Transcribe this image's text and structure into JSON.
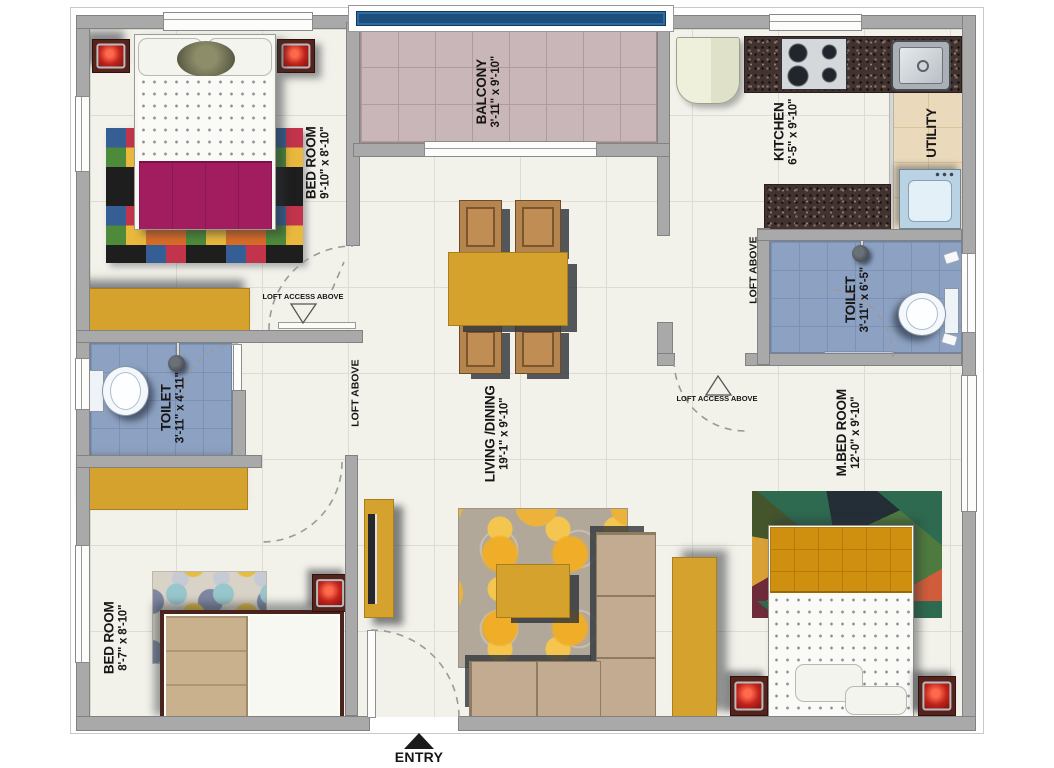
{
  "plan": {
    "rooms": {
      "bedroom_top_left": {
        "name": "BED ROOM",
        "dims": "9'-10\" x 8'-10\""
      },
      "balcony": {
        "name": "BALCONY",
        "dims": "3'-11\" x 9'-10\""
      },
      "kitchen": {
        "name": "KITCHEN",
        "dims": "6'-5\" x 9'-10\""
      },
      "utility": {
        "name": "UTILITY"
      },
      "toilet_right": {
        "name": "TOILET",
        "dims": "3'-11\" x 6'-5\""
      },
      "master_bedroom": {
        "name": "M.BED ROOM",
        "dims": "12'-0\" x 9'-10\""
      },
      "toilet_left": {
        "name": "TOILET",
        "dims": "3'-11\" x 4'-11\""
      },
      "living_dining": {
        "name": "LIVING /DINING",
        "dims": "19'-1\" x 9'-10\""
      },
      "bedroom_bottom_left": {
        "name": "BED ROOM",
        "dims": "8'-7\" x 8'-10\""
      }
    },
    "annotations": {
      "loft_above_left": "LOFT ABOVE",
      "loft_above_right": "LOFT ABOVE",
      "loft_access_above_left": "LOFT ACCESS ABOVE",
      "loft_access_above_right": "LOFT ACCESS ABOVE",
      "entry": "ENTRY"
    },
    "colors": {
      "wall": "#a9a9a9",
      "floor": "#f2f1ea",
      "balcony_floor": "#c9b6b8",
      "toilet_floor": "#8da2c2",
      "utility_floor": "#eadabb",
      "furniture_gold": "#d5a22d",
      "sofa_tan": "#c3ab92",
      "chair_brown": "#b5854f",
      "bed1_blanket": "#a11d60",
      "mbed_headboard": "#cf9010",
      "railing_blue": "#1c4f7d",
      "granite": "#423230"
    }
  }
}
